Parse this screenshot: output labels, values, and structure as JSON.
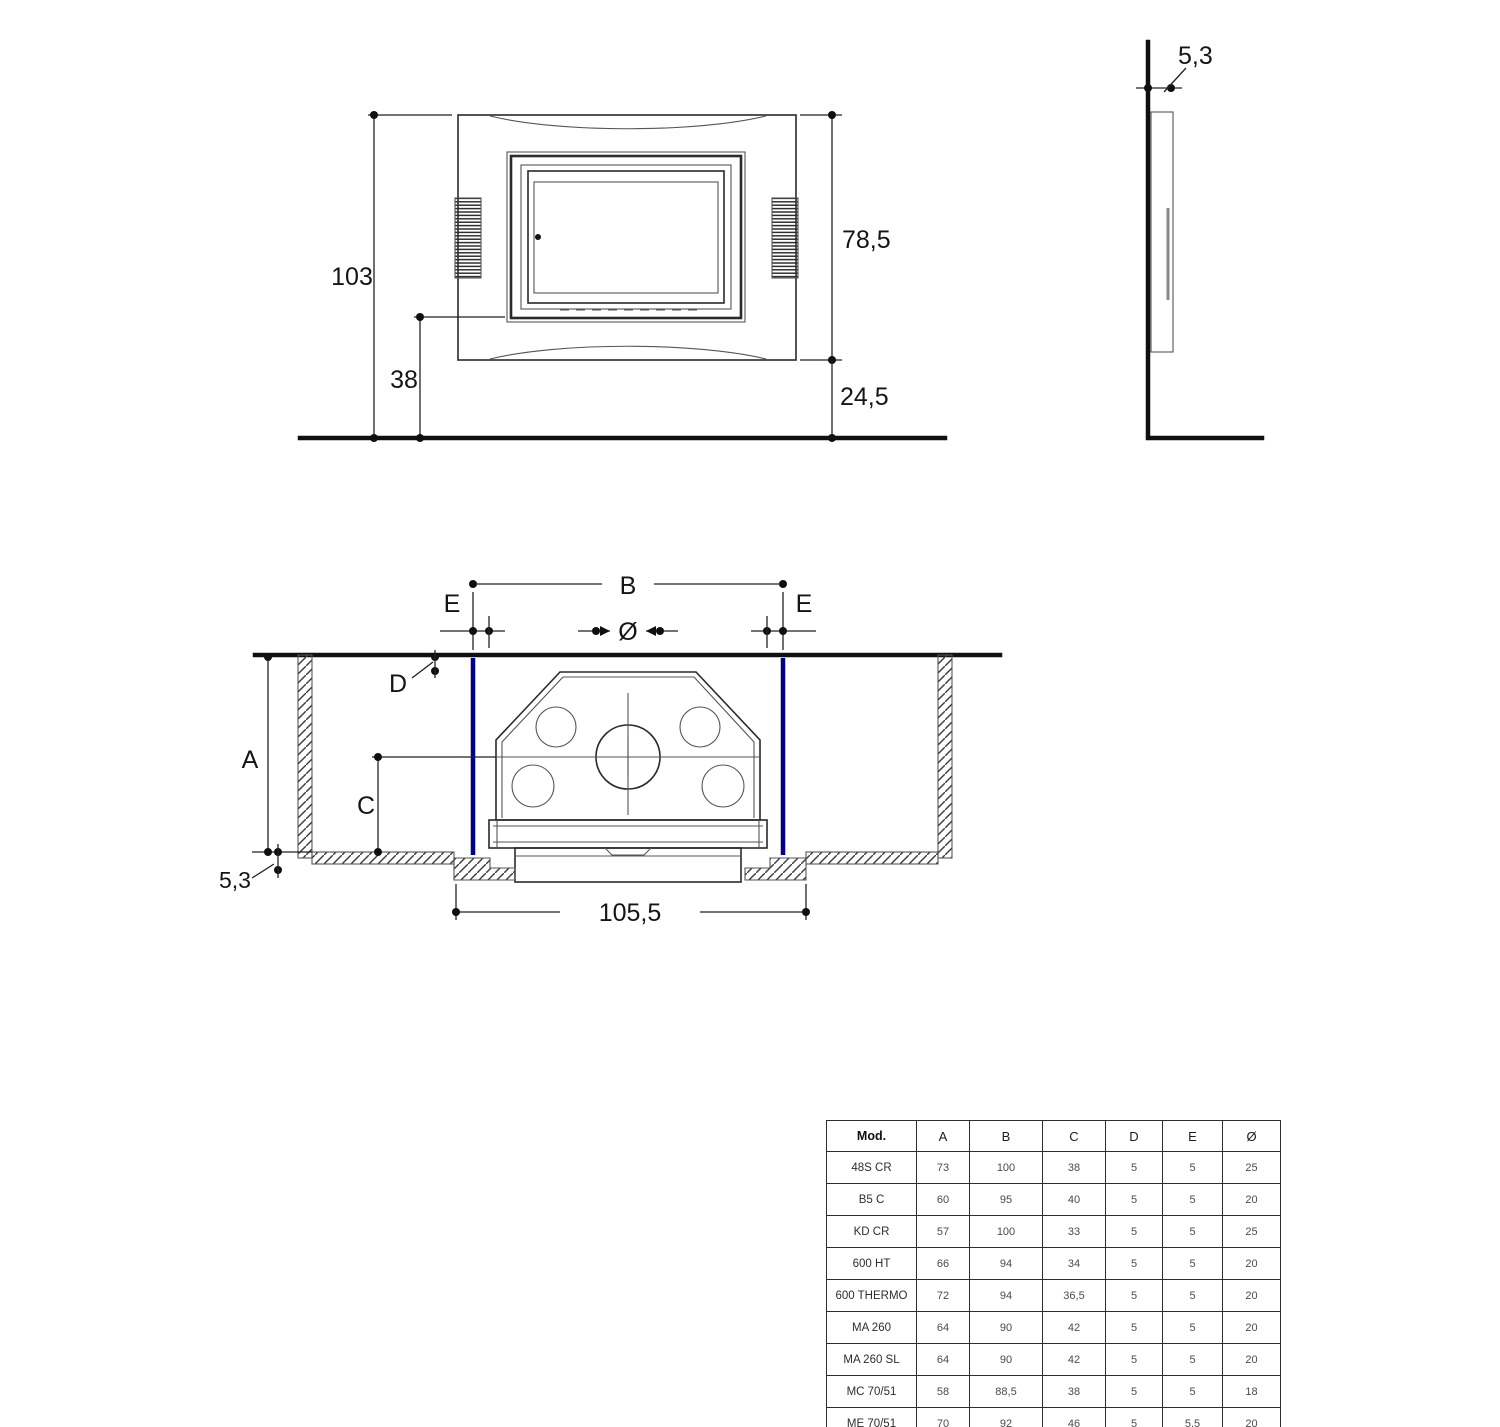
{
  "front_view": {
    "labels": {
      "total_height": "103",
      "inner_height": "38",
      "frame_height": "78,5",
      "bottom_height": "24,5"
    }
  },
  "side_view": {
    "labels": {
      "frame_depth": "5,3"
    }
  },
  "plan_view": {
    "labels": {
      "B": "B",
      "E_left": "E",
      "E_right": "E",
      "diameter": "Ø",
      "D": "D",
      "A": "A",
      "C": "C",
      "floor_thickness": "5,3",
      "overall_width": "105,5"
    }
  },
  "colors": {
    "accent_blue": "#00008B",
    "line": "#2a2a2a"
  },
  "table": {
    "headers": [
      "Mod.",
      "A",
      "B",
      "C",
      "D",
      "E",
      "Ø"
    ],
    "rows": [
      [
        "48S CR",
        "73",
        "100",
        "38",
        "5",
        "5",
        "25"
      ],
      [
        "B5 C",
        "60",
        "95",
        "40",
        "5",
        "5",
        "20"
      ],
      [
        "KD CR",
        "57",
        "100",
        "33",
        "5",
        "5",
        "25"
      ],
      [
        "600 HT",
        "66",
        "94",
        "34",
        "5",
        "5",
        "20"
      ],
      [
        "600 THERMO",
        "72",
        "94",
        "36,5",
        "5",
        "5",
        "20"
      ],
      [
        "MA 260",
        "64",
        "90",
        "42",
        "5",
        "5",
        "20"
      ],
      [
        "MA 260 SL",
        "64",
        "90",
        "42",
        "5",
        "5",
        "20"
      ],
      [
        "MC 70/51",
        "58",
        "88,5",
        "38",
        "5",
        "5",
        "18"
      ],
      [
        "ME 70/51",
        "70",
        "92",
        "46",
        "5",
        "5,5",
        "20"
      ]
    ]
  }
}
